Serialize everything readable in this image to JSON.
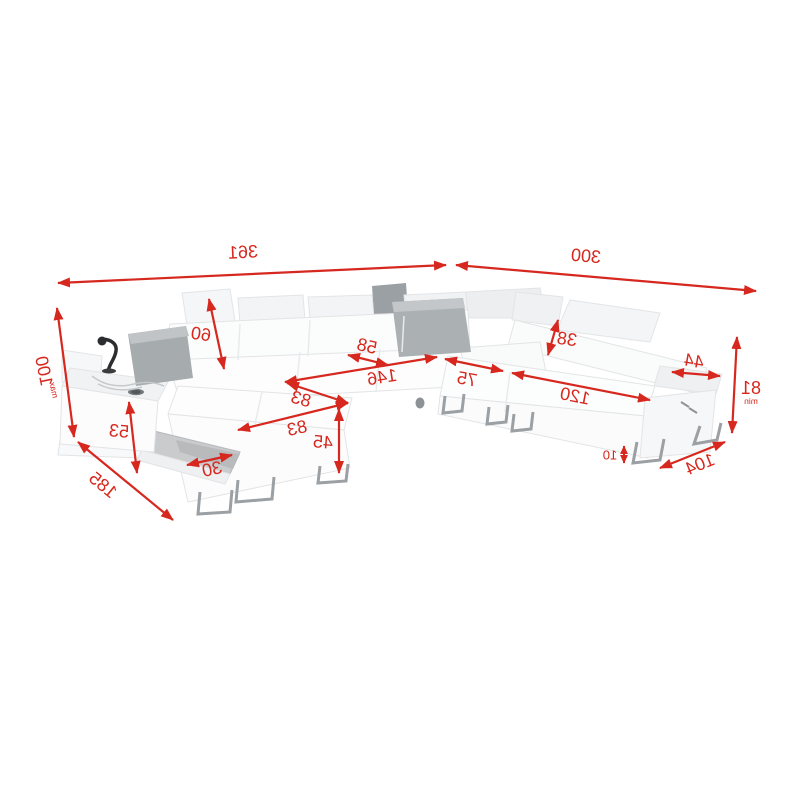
{
  "diagram": {
    "type": "product-dimension-drawing",
    "subject": "u-shaped-corner-sofa-with-sleep-function",
    "orientation": "mirrored-horizontally",
    "background_color": "#ffffff",
    "accent_color": "#d6281e",
    "sofa_color": "#fafbfb",
    "pillow_color": "#a6abae",
    "leg_color": "#9ba0a4"
  },
  "dimensions": {
    "total_length": "361",
    "total_depth": "300",
    "height_max": "100",
    "height_max_note": "max",
    "backrest_height": "60",
    "console_height": "53",
    "chaise_side_length": "185",
    "storage_opening_width": "30",
    "bed_width_front": "83",
    "bed_width_back": "83",
    "front_height": "45",
    "seat_depth": "58",
    "bed_length": "146",
    "seat_width": "75",
    "ottoman_length": "120",
    "headrest_height": "38",
    "armrest_width": "44",
    "height_min": "81",
    "height_min_note": "min",
    "end_section_depth": "104",
    "leg_height": "10"
  }
}
